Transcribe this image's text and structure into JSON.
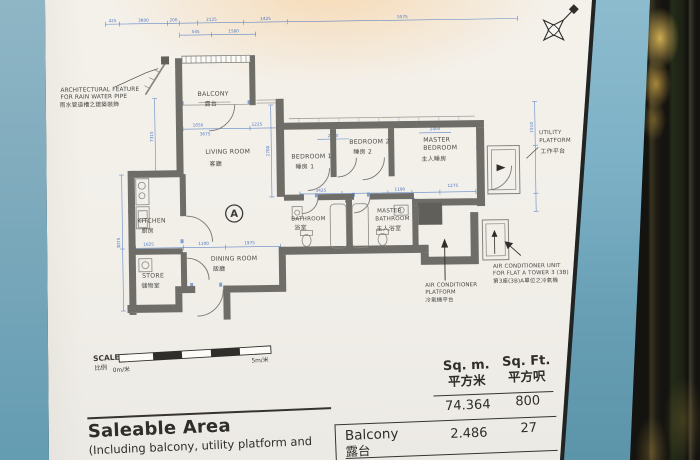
{
  "floor_plan": {
    "flat_marker": "A",
    "rooms": {
      "balcony": {
        "en": "BALCONY",
        "zh": "露台"
      },
      "living": {
        "en": "LIVING ROOM",
        "zh": "客廳"
      },
      "bedroom1": {
        "en": "BEDROOM 1",
        "zh": "睡房 1"
      },
      "bedroom2": {
        "en": "BEDROOM 2",
        "zh": "睡房 2"
      },
      "master_bedroom": {
        "en1": "MASTER",
        "en2": "BEDROOM",
        "zh": "主人睡房"
      },
      "utility": {
        "en1": "UTILITY",
        "en2": "PLATFORM",
        "zh": "工作平台"
      },
      "kitchen": {
        "en": "KITCHEN",
        "zh": "廚房"
      },
      "store": {
        "en": "STORE",
        "zh": "儲物室"
      },
      "dining": {
        "en": "DINING ROOM",
        "zh": "飯廳"
      },
      "bathroom": {
        "en": "BATHROOM",
        "zh": "浴室"
      },
      "master_bathroom": {
        "en1": "MASTER",
        "en2": "BATHROOM",
        "zh": "主人浴室"
      }
    },
    "callouts": {
      "arch_feature": {
        "l1": "ARCHITECTURAL FEATURE",
        "l2": "FOR RAIN WATER PIPE",
        "zh": "雨水管道槽之建築裝飾"
      },
      "ac_platform": {
        "l1": "AIR CONDITIONER",
        "l2": "PLATFORM",
        "zh": "冷氣機平台"
      },
      "ac_unit": {
        "l1": "AIR CONDITIONER UNIT",
        "l2": "FOR FLAT A TOWER 3 (3B)",
        "zh": "第3座(3B)A單位之冷氣機"
      }
    },
    "dims": {
      "top": [
        "425",
        "3800",
        "200",
        "2125",
        "1425",
        "5575"
      ],
      "top2": [
        "545",
        "1580"
      ],
      "inner": [
        "1850",
        "1225",
        "3675",
        "2050",
        "2400",
        "3425",
        "1190",
        "1275",
        "1100",
        "1975",
        "1825"
      ],
      "side": [
        "7315",
        "2700",
        "1510",
        "3075"
      ]
    }
  },
  "scale_bar": {
    "en": "SCALE",
    "zh": "比例",
    "start": "0m/米",
    "end": "5m/米"
  },
  "area_table": {
    "col_sqm": {
      "en": "Sq. m.",
      "zh": "平方米"
    },
    "col_sqft": {
      "en": "Sq. Ft.",
      "zh": "平方呎"
    },
    "saleable_row": {
      "sqm": "74.364",
      "sqft": "800"
    },
    "balcony_row": {
      "en": "Balcony",
      "zh": "露台",
      "sqm": "2.486",
      "sqft": "27"
    }
  },
  "saleable_area": {
    "title": "Saleable Area",
    "note": "(Including balcony, utility platform and"
  }
}
